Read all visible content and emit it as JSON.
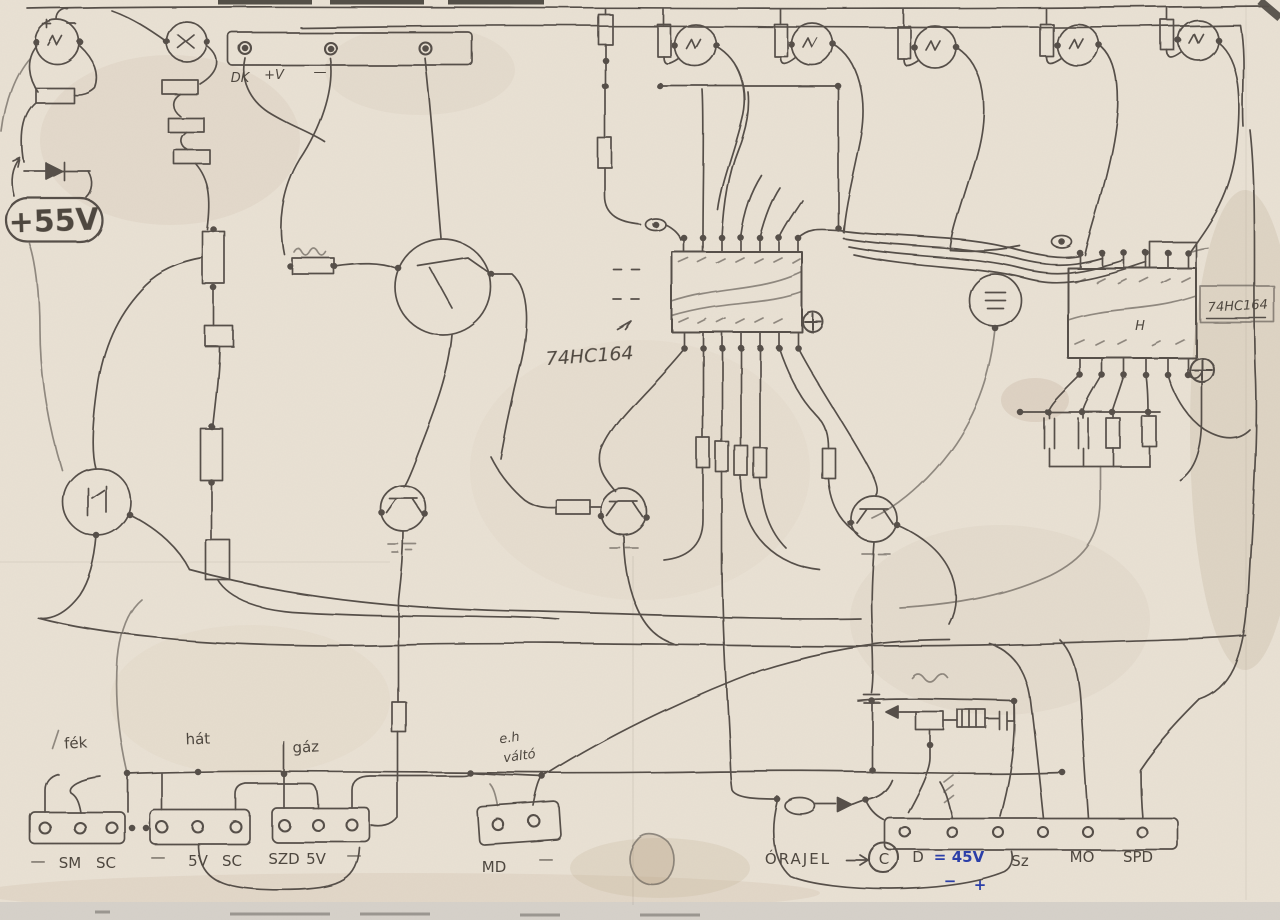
{
  "document": {
    "kind": "Scanned hand-drawn circuit schematic (pencil on creased paper)",
    "language": "Hungarian"
  },
  "colors": {
    "paper": "#e9e1d4",
    "pencil": "#57504a",
    "pencil_dark": "#3c362e",
    "blue_ink": "#2c3fa8",
    "stain": "#c8b49c"
  },
  "annotations": {
    "supply": "+55V",
    "dk": "DK",
    "plus_v": "+V",
    "top_minus": "—",
    "ic1_label": "74HC164",
    "ic2_label": "74HC164",
    "ic2_pin": "H",
    "brake": "fék",
    "reverse": "hát",
    "throttle": "gáz",
    "switch_line1": "e.h",
    "switch_line2": "váltó",
    "md": "MD",
    "md_minus": "—",
    "orajel": "ÓRAJEL",
    "clock_c": "C",
    "d": "D",
    "eq45": "=",
    "v45": "45V",
    "blue_minus": "−",
    "blue_plus": "+",
    "sz": "Sz",
    "mo": "MO",
    "spd": "SPD"
  },
  "terminals_left": [
    "—",
    "SM",
    "SC",
    "—",
    "5V",
    "SC",
    "SZD",
    "5V",
    "—"
  ]
}
